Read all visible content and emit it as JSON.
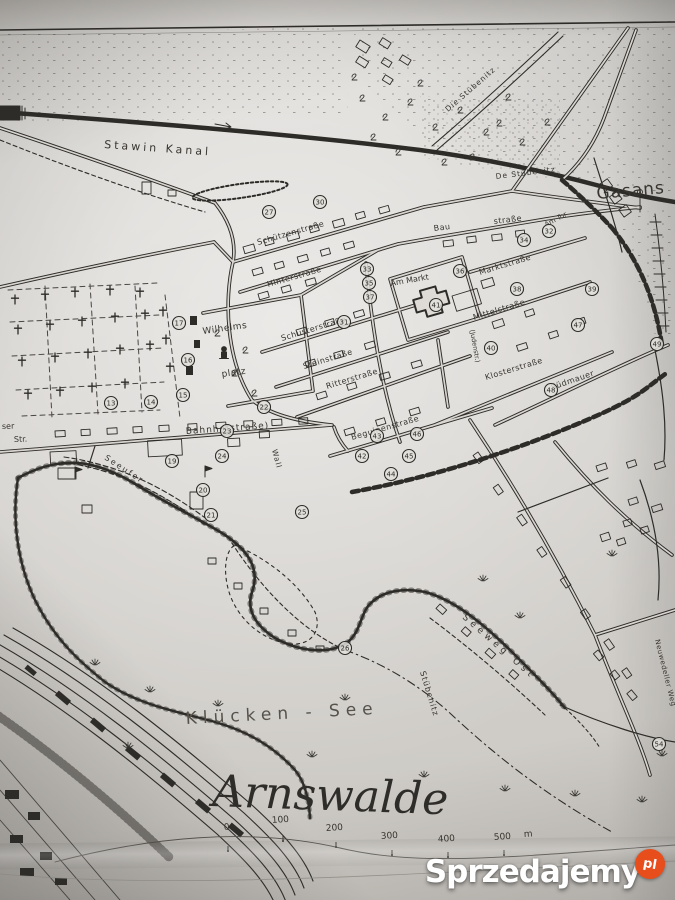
{
  "map": {
    "title": "Arnswalde",
    "lake_label": "Klücken - See",
    "labels": [
      {
        "text": "Stawin Kanal",
        "x": 104,
        "y": 148,
        "r": 4,
        "s": 11,
        "ls": 3
      },
      {
        "text": "Die Stübenitz",
        "x": 448,
        "y": 112,
        "r": -41,
        "s": 7.5,
        "ls": 1
      },
      {
        "text": "De Stübenitz",
        "x": 496,
        "y": 179,
        "r": -7,
        "s": 7.5,
        "ls": 1
      },
      {
        "text": "Gasans",
        "x": 597,
        "y": 199,
        "r": -5,
        "s": 17,
        "ls": 1
      },
      {
        "text": "Schützenstraße",
        "x": 258,
        "y": 245,
        "r": -16,
        "s": 8,
        "ls": 0.5
      },
      {
        "text": "Hinterstraße",
        "x": 268,
        "y": 287,
        "r": -16,
        "s": 8,
        "ls": 0.5
      },
      {
        "text": "Bau",
        "x": 434,
        "y": 231,
        "r": -7,
        "s": 8,
        "ls": 0.5
      },
      {
        "text": "straße",
        "x": 494,
        "y": 224,
        "r": -7,
        "s": 8,
        "ls": 0.5
      },
      {
        "text": "Am Tor",
        "x": 546,
        "y": 227,
        "r": -28,
        "s": 7,
        "ls": 0
      },
      {
        "text": "Marktstraße",
        "x": 480,
        "y": 275,
        "r": -17,
        "s": 8,
        "ls": 0.5
      },
      {
        "text": "Am Markt",
        "x": 391,
        "y": 286,
        "r": -10,
        "s": 8,
        "ls": 0
      },
      {
        "text": "Mittelstraße",
        "x": 474,
        "y": 320,
        "r": -17,
        "s": 8,
        "ls": 0.5
      },
      {
        "text": "Schusterstraße",
        "x": 282,
        "y": 341,
        "r": -17,
        "s": 8,
        "ls": 0.5
      },
      {
        "text": "Steinstraße",
        "x": 304,
        "y": 369,
        "r": -17,
        "s": 8,
        "ls": 0.5
      },
      {
        "text": "Ritterstraße",
        "x": 327,
        "y": 389,
        "r": -17,
        "s": 8,
        "ls": 0.5
      },
      {
        "text": "Klosterstraße",
        "x": 486,
        "y": 380,
        "r": -17,
        "s": 8,
        "ls": 0.5
      },
      {
        "text": "Südmauer",
        "x": 552,
        "y": 390,
        "r": -19,
        "s": 8,
        "ls": 0.5
      },
      {
        "text": "Beguinenstraße",
        "x": 352,
        "y": 440,
        "r": -16,
        "s": 8,
        "ls": 0.5
      },
      {
        "text": "(Judenstr.)",
        "x": 470,
        "y": 330,
        "r": 80,
        "s": 6.5,
        "ls": 0
      },
      {
        "text": "Wilhelms",
        "x": 203,
        "y": 334,
        "r": -8,
        "s": 9,
        "ls": 0.5
      },
      {
        "text": "platz",
        "x": 222,
        "y": 377,
        "r": -8,
        "s": 9,
        "ls": 0.5
      },
      {
        "text": "Bahnhofstraße)",
        "x": 186,
        "y": 434,
        "r": -4,
        "s": 9,
        "ls": 1
      },
      {
        "text": "ser",
        "x": 2,
        "y": 429,
        "r": -2,
        "s": 8,
        "ls": 0
      },
      {
        "text": "Str.",
        "x": 14,
        "y": 442,
        "r": -2,
        "s": 8,
        "ls": 0
      },
      {
        "text": "Seeufer",
        "x": 104,
        "y": 459,
        "r": 33,
        "s": 8,
        "ls": 2
      },
      {
        "text": "Wall",
        "x": 272,
        "y": 450,
        "r": 75,
        "s": 7.5,
        "ls": 1
      },
      {
        "text": "Seeweg Ost",
        "x": 462,
        "y": 618,
        "r": 41,
        "s": 9,
        "ls": 4
      },
      {
        "text": "Stübenitz",
        "x": 420,
        "y": 672,
        "r": 73,
        "s": 8,
        "ls": 1
      },
      {
        "text": "Neuwedeller Weg",
        "x": 655,
        "y": 640,
        "r": 76,
        "s": 7,
        "ls": 0.5
      }
    ],
    "pois": [
      {
        "n": "13",
        "x": 111,
        "y": 403
      },
      {
        "n": "14",
        "x": 151,
        "y": 402
      },
      {
        "n": "15",
        "x": 183,
        "y": 395
      },
      {
        "n": "16",
        "x": 188,
        "y": 360
      },
      {
        "n": "17",
        "x": 179,
        "y": 323
      },
      {
        "n": "19",
        "x": 172,
        "y": 461
      },
      {
        "n": "20",
        "x": 203,
        "y": 490
      },
      {
        "n": "21",
        "x": 211,
        "y": 515
      },
      {
        "n": "22",
        "x": 264,
        "y": 407
      },
      {
        "n": "23",
        "x": 227,
        "y": 431
      },
      {
        "n": "24",
        "x": 222,
        "y": 456
      },
      {
        "n": "25",
        "x": 302,
        "y": 512
      },
      {
        "n": "26",
        "x": 345,
        "y": 648
      },
      {
        "n": "27",
        "x": 269,
        "y": 212
      },
      {
        "n": "30",
        "x": 320,
        "y": 202
      },
      {
        "n": "31",
        "x": 344,
        "y": 322
      },
      {
        "n": "32",
        "x": 549,
        "y": 231
      },
      {
        "n": "33",
        "x": 367,
        "y": 269
      },
      {
        "n": "34",
        "x": 524,
        "y": 240
      },
      {
        "n": "35",
        "x": 369,
        "y": 283
      },
      {
        "n": "36",
        "x": 460,
        "y": 271
      },
      {
        "n": "37",
        "x": 370,
        "y": 297
      },
      {
        "n": "38",
        "x": 517,
        "y": 289
      },
      {
        "n": "39",
        "x": 592,
        "y": 289
      },
      {
        "n": "40",
        "x": 491,
        "y": 348
      },
      {
        "n": "41",
        "x": 436,
        "y": 305
      },
      {
        "n": "42",
        "x": 362,
        "y": 456
      },
      {
        "n": "43",
        "x": 377,
        "y": 436
      },
      {
        "n": "44",
        "x": 391,
        "y": 474
      },
      {
        "n": "45",
        "x": 409,
        "y": 456
      },
      {
        "n": "46",
        "x": 417,
        "y": 434
      },
      {
        "n": "47",
        "x": 578,
        "y": 325
      },
      {
        "n": "48",
        "x": 551,
        "y": 390
      },
      {
        "n": "49",
        "x": 657,
        "y": 344
      },
      {
        "n": "54",
        "x": 659,
        "y": 744
      }
    ],
    "scale": {
      "marks": [
        {
          "label": "0",
          "lx": 224,
          "ly": 830,
          "tx": 228,
          "ty": 851
        },
        {
          "label": "100",
          "lx": 272,
          "ly": 823,
          "tx": 283,
          "ty": 841
        },
        {
          "label": "200",
          "lx": 326,
          "ly": 831,
          "tx": 336,
          "ty": 847
        },
        {
          "label": "300",
          "lx": 381,
          "ly": 839,
          "tx": 392,
          "ty": 855
        },
        {
          "label": "400",
          "lx": 438,
          "ly": 842,
          "tx": 448,
          "ty": 857
        },
        {
          "label": "500",
          "lx": 494,
          "ly": 840,
          "tx": 504,
          "ty": 855
        }
      ],
      "suffix": "m",
      "sx": 524,
      "sy": 837
    }
  },
  "watermark": {
    "brand": "Sprzedajemy",
    "tld": "pl",
    "badge_color": "#e84d1c"
  }
}
